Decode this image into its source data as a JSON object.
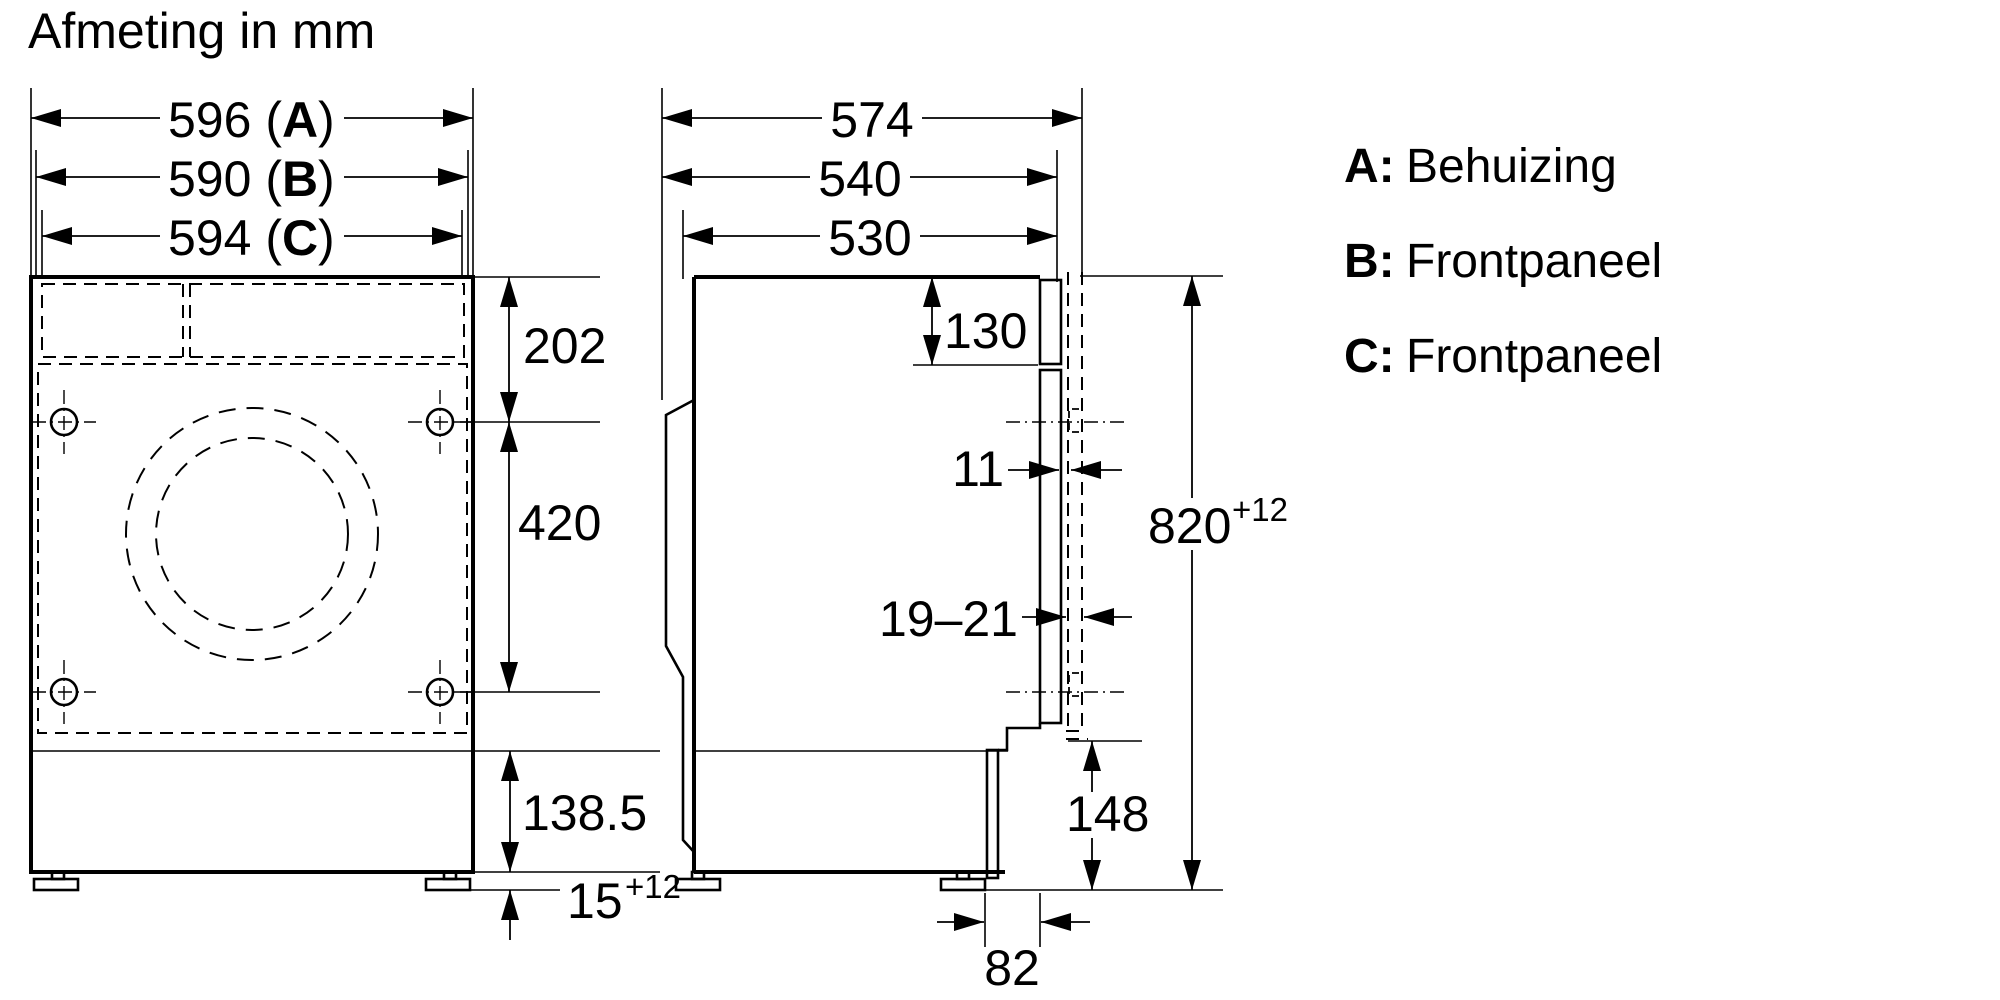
{
  "title": "Afmeting in mm",
  "front_view": {
    "width_dims": [
      {
        "prefix": "596 (",
        "letter": "A",
        "suffix": ")"
      },
      {
        "prefix": "590 (",
        "letter": "B",
        "suffix": ")"
      },
      {
        "prefix": "594 (",
        "letter": "C",
        "suffix": ")"
      }
    ],
    "height_dims": {
      "top": "202",
      "middle": "420",
      "plinth": "138.5",
      "foot": {
        "value": "15",
        "tolerance": "+12"
      }
    }
  },
  "side_view": {
    "depth_dims": [
      "574",
      "540",
      "530"
    ],
    "panel_top": "130",
    "gap": "11",
    "door_thickness": "19–21",
    "niche_height": {
      "value": "820",
      "tolerance": "+12"
    },
    "plinth_height": "148",
    "recess": "82"
  },
  "legend": [
    {
      "key": "A:",
      "label": "Behuizing"
    },
    {
      "key": "B:",
      "label": "Frontpaneel"
    },
    {
      "key": "C:",
      "label": "Frontpaneel"
    }
  ],
  "colors": {
    "line": "#000000",
    "background": "#ffffff"
  }
}
